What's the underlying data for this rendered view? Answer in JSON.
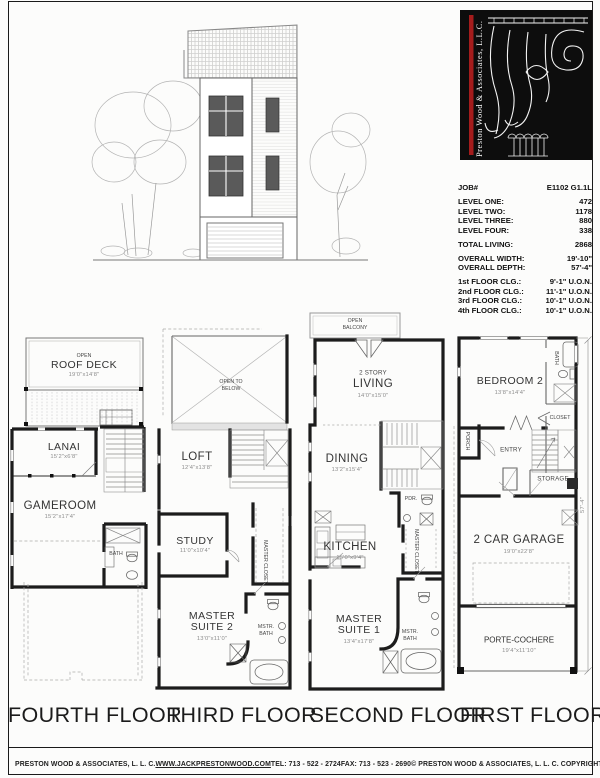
{
  "page": {
    "labels": {
      "fourth": "FOURTH FLOOR",
      "third": "THIRD FLOOR",
      "second": "SECOND FLOOR",
      "first": "FIRST FLOOR"
    },
    "footer": {
      "company": "PRESTON WOOD & ASSOCIATES, L. L. C.",
      "website": "WWW.JACKPRESTONWOOD.COM",
      "tel": "TEL:  713 - 522 - 2724",
      "fax": "FAX:  713 - 523 - 2690",
      "copyright": "© PRESTON WOOD & ASSOCIATES, L. L. C.  COPYRIGHT"
    }
  },
  "logo": {
    "company_vertical": "Preston Wood & Associates, L.L.C.",
    "bg_color": "#0d0d0d",
    "accent_color": "#a51c1c"
  },
  "job": {
    "job_label": "JOB#",
    "job_value": "E1102 G1.1L",
    "levels": [
      {
        "label": "LEVEL ONE:",
        "value": "472"
      },
      {
        "label": "LEVEL TWO:",
        "value": "1178"
      },
      {
        "label": "LEVEL THREE:",
        "value": "880"
      },
      {
        "label": "LEVEL FOUR:",
        "value": "338"
      }
    ],
    "total_label": "TOTAL LIVING:",
    "total_value": "2868",
    "overall": [
      {
        "label": "OVERALL WIDTH:",
        "value": "19'-10\""
      },
      {
        "label": "OVERALL DEPTH:",
        "value": "57'-4\""
      }
    ],
    "ceilings": [
      {
        "label": "1st FLOOR CLG.:",
        "value": "9'-1\" U.O.N."
      },
      {
        "label": "2nd FLOOR CLG.:",
        "value": "11'-1\" U.O.N."
      },
      {
        "label": "3rd FLOOR CLG.:",
        "value": "10'-1\" U.O.N."
      },
      {
        "label": "4th FLOOR CLG.:",
        "value": "10'-1\" U.O.N."
      }
    ]
  },
  "floors": {
    "fourth": {
      "roof_deck_open": "OPEN",
      "roof_deck": "ROOF DECK",
      "roof_deck_dims": "19'0\"x14'8\"",
      "lanai": "LANAI",
      "lanai_dims": "15'2\"x6'8\"",
      "gameroom": "GAMEROOM",
      "gameroom_dims": "15'2\"x17'4\"",
      "bath": "BATH"
    },
    "third": {
      "open_to": "OPEN TO",
      "below": "BELOW",
      "loft": "LOFT",
      "loft_dims": "12'4\"x13'8\"",
      "study": "STUDY",
      "study_dims": "11'0\"x10'4\"",
      "master_closet": "MASTER CLOSET",
      "suite_l1": "MASTER",
      "suite_l2": "SUITE 2",
      "suite_dims": "13'0\"x11'0\"",
      "mstr": "MSTR.",
      "bath": "BATH"
    },
    "second": {
      "balcony_l1": "OPEN",
      "balcony_l2": "BALCONY",
      "living_l1": "2 STORY",
      "living_l2": "LIVING",
      "living_dims": "14'0\"x15'0\"",
      "dining": "DINING",
      "dining_dims": "13'2\"x15'4\"",
      "pdr": "PDR.",
      "kitchen": "KITCHEN",
      "kitchen_dims": "15'0\"x9'4\"",
      "master_closet": "MASTER CLOSET",
      "suite_l1": "MASTER",
      "suite_l2": "SUITE 1",
      "suite_dims": "13'4\"x17'8\"",
      "mstr": "MSTR.",
      "bath": "BATH"
    },
    "first": {
      "bedroom": "BEDROOM 2",
      "bedroom_dims": "13'8\"x14'4\"",
      "bath": "BATH",
      "closet": "CLOSET",
      "porch": "PORCH",
      "entry": "ENTRY",
      "storage": "STORAGE",
      "garage": "2 CAR GARAGE",
      "garage_dims": "19'0\"x22'8\"",
      "porte": "PORTE-COCHERE",
      "porte_dims": "19'4\"x11'10\"",
      "depth_dim": "57'-4\""
    }
  }
}
